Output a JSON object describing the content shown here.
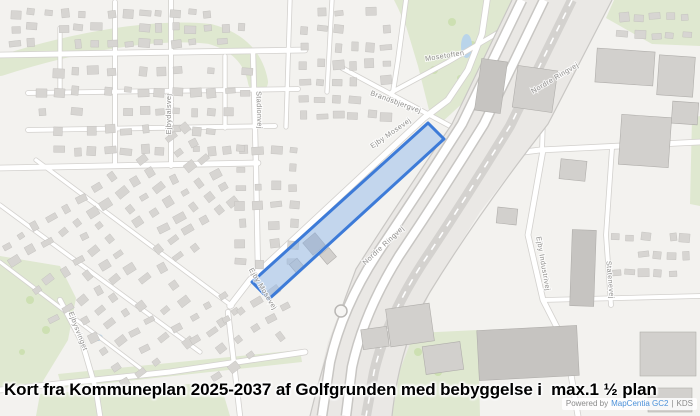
{
  "caption": {
    "text": "Kort fra Kommuneplan 2025-2037 af Golfgrunden med bebyggelse i  max.1 ½ plan"
  },
  "attribution": {
    "powered_by": "Powered by",
    "provider": "MapCentia GC2",
    "separator": "|",
    "suffix": "KDS"
  },
  "map": {
    "background": "#f3f2ef",
    "colors": {
      "green": "#dfe8d0",
      "tree": "#cde0b2",
      "water": "#b9d4ea",
      "building": "#d7d5d2",
      "building_dark": "#c6c4c1",
      "building_light": "#d2d0cd",
      "street_casing": "#d3d1ce",
      "street_fill": "#ffffff",
      "corridor": "#eae8e5",
      "road_casing": "#c8c6c3",
      "rail": "#d4d2cf",
      "label": "#8f8e8c",
      "zone_fill": "#8ab4ea",
      "zone_stroke": "#3d7bd8"
    },
    "greens": [
      "394,0 545,0 536,16 498,62 466,100 440,124 430,114 418,66 406,26 398,8",
      "548,0 610,0 562,96 540,130 524,104 538,58",
      "0,256 60,266 76,298 68,340 40,386 0,390",
      "58,374 300,350 302,362 62,388",
      "40,394 220,382 230,416 36,416",
      "396,334 478,330 480,416 370,416 382,368",
      "614,0 700,0 700,46 652,44 606,18",
      "692,118 700,116 700,206 690,204"
    ],
    "green_band": "M 0,66 C 80,40 160,28 210,34 C 240,42 254,60 258,82",
    "trees": [
      [
        452,
        22,
        4
      ],
      [
        472,
        46,
        5
      ],
      [
        498,
        34,
        4
      ],
      [
        434,
        70,
        4
      ],
      [
        460,
        78,
        3
      ],
      [
        524,
        12,
        4
      ],
      [
        540,
        16,
        3
      ],
      [
        30,
        300,
        4
      ],
      [
        46,
        330,
        4
      ],
      [
        22,
        352,
        3
      ],
      [
        418,
        352,
        4
      ],
      [
        438,
        372,
        4
      ]
    ],
    "ponds": [
      [
        461,
        34,
        11,
        24
      ],
      [
        93,
        334,
        10,
        7
      ]
    ],
    "streets": [
      {
        "pts": [
          [
            0,
            55
          ],
          [
            305,
            50
          ]
        ],
        "w": 5
      },
      {
        "pts": [
          [
            28,
            93
          ],
          [
            298,
            89
          ]
        ],
        "w": 4
      },
      {
        "pts": [
          [
            28,
            130
          ],
          [
            275,
            126
          ]
        ],
        "w": 4
      },
      {
        "pts": [
          [
            0,
            168
          ],
          [
            258,
            163
          ]
        ],
        "w": 5
      },
      {
        "pts": [
          [
            115,
            2
          ],
          [
            115,
            166
          ]
        ],
        "w": 4
      },
      {
        "pts": [
          [
            171,
            0
          ],
          [
            171,
            166
          ]
        ],
        "w": 4
      },
      {
        "pts": [
          [
            225,
            56
          ],
          [
            225,
            128
          ]
        ],
        "w": 3.5
      },
      {
        "pts": [
          [
            253,
            52
          ],
          [
            256,
            168
          ],
          [
            258,
            272
          ]
        ],
        "w": 4.5
      },
      {
        "pts": [
          [
            60,
            28
          ],
          [
            60,
            93
          ]
        ],
        "w": 3.5
      },
      {
        "pts": [
          [
            290,
            0
          ],
          [
            286,
            127
          ]
        ],
        "w": 3.5
      },
      {
        "pts": [
          [
            332,
            0
          ],
          [
            327,
            92
          ]
        ],
        "w": 3.5
      },
      {
        "pts": [
          [
            228,
            312
          ],
          [
            240,
            416
          ]
        ],
        "w": 4.5
      },
      {
        "pts": [
          [
            0,
            390
          ],
          [
            170,
            372
          ],
          [
            305,
            352
          ]
        ],
        "w": 5
      },
      {
        "pts": [
          [
            60,
            300
          ],
          [
            82,
            342
          ],
          [
            96,
            390
          ],
          [
            100,
            416
          ]
        ],
        "w": 4.5
      },
      {
        "pts": [
          [
            230,
            306
          ],
          [
            250,
            280
          ],
          [
            424,
            118
          ],
          [
            448,
            100
          ],
          [
            468,
            70
          ],
          [
            482,
            34
          ],
          [
            487,
            0
          ]
        ],
        "w": 5.5
      },
      {
        "pts": [
          [
            342,
            68
          ],
          [
            450,
            126
          ]
        ],
        "w": 4
      },
      {
        "pts": [
          [
            392,
            92
          ],
          [
            448,
            62
          ],
          [
            530,
            14
          ]
        ],
        "w": 4
      },
      {
        "pts": [
          [
            406,
            0
          ],
          [
            398,
            60
          ],
          [
            393,
            92
          ]
        ],
        "w": 4
      },
      {
        "pts": [
          [
            500,
            155
          ],
          [
            540,
            150
          ],
          [
            700,
            142
          ]
        ],
        "w": 5
      },
      {
        "pts": [
          [
            545,
            58
          ],
          [
            542,
            150
          ]
        ],
        "w": 4
      },
      {
        "pts": [
          [
            543,
            150
          ],
          [
            528,
            235
          ],
          [
            543,
            300
          ],
          [
            566,
            345
          ],
          [
            578,
            416
          ]
        ],
        "w": 5
      },
      {
        "pts": [
          [
            612,
            148
          ],
          [
            606,
            235
          ],
          [
            611,
            305
          ]
        ],
        "w": 4
      },
      {
        "pts": [
          [
            543,
            300
          ],
          [
            700,
            296
          ]
        ],
        "w": 4
      },
      {
        "pts": [
          [
            0,
            205
          ],
          [
            200,
            352
          ]
        ],
        "w": 3.5
      },
      {
        "pts": [
          [
            36,
            160
          ],
          [
            232,
            306
          ]
        ],
        "w": 3.5
      },
      {
        "pts": [
          [
            0,
            262
          ],
          [
            140,
            368
          ]
        ],
        "w": 3
      }
    ],
    "corridor": {
      "outline": "512,0 612,0 548,124 480,212 430,292 400,370 392,416 310,416 328,342 356,269 392,212 452,124",
      "roads": [
        "M522,0 L462,124 Q420,190 377,254 Q342,308 330,362 L322,416",
        "M544,0 L484,124 Q442,192 399,256 Q364,312 352,367 L346,416"
      ],
      "rail": "M572,0 L510,126 Q466,198 422,264 Q386,320 374,372 L366,416",
      "edge_ne": "M612,0 L548,124 Q478,214 430,292 Q400,342 392,416",
      "edge_sw": "M512,0 L452,124 Q392,212 356,269 Q328,342 310,416",
      "roundabout": {
        "cx": 341,
        "cy": 311,
        "r": 6
      }
    },
    "zone": {
      "points": "252,282 428,123 444,139 269,299"
    },
    "buildings_large": [
      [
        478,
        60,
        26,
        52,
        8,
        "b"
      ],
      [
        515,
        68,
        40,
        42,
        8,
        "a"
      ],
      [
        596,
        50,
        58,
        34,
        4,
        "a"
      ],
      [
        658,
        56,
        36,
        40,
        4,
        "a"
      ],
      [
        620,
        116,
        50,
        50,
        4,
        "a"
      ],
      [
        672,
        102,
        26,
        22,
        4,
        "a"
      ],
      [
        560,
        160,
        26,
        20,
        6,
        "a"
      ],
      [
        497,
        208,
        20,
        16,
        6,
        "a"
      ],
      [
        571,
        230,
        24,
        76,
        2,
        "b"
      ],
      [
        478,
        328,
        100,
        50,
        -3,
        "b"
      ],
      [
        388,
        306,
        44,
        38,
        -8,
        "a"
      ],
      [
        424,
        344,
        38,
        28,
        -8,
        "a"
      ],
      [
        362,
        328,
        26,
        20,
        -8,
        "a"
      ],
      [
        640,
        332,
        56,
        44,
        0,
        "a"
      ],
      [
        648,
        388,
        44,
        24,
        0,
        "a"
      ],
      [
        306,
        236,
        16,
        16,
        -40,
        "b"
      ],
      [
        322,
        250,
        12,
        12,
        -40,
        "a"
      ],
      [
        292,
        260,
        10,
        12,
        -40,
        "a"
      ]
    ],
    "building_regions": [
      [
        8,
        6,
        240,
        44,
        0,
        15,
        3
      ],
      [
        296,
        4,
        100,
        120,
        0,
        6,
        7
      ],
      [
        34,
        62,
        220,
        98,
        0,
        13,
        5
      ],
      [
        4,
        172,
        232,
        104,
        -33,
        13,
        6
      ],
      [
        84,
        268,
        150,
        96,
        -33,
        8,
        5
      ],
      [
        232,
        140,
        70,
        132,
        0,
        4,
        7
      ],
      [
        610,
        228,
        82,
        54,
        0,
        6,
        3
      ],
      [
        190,
        302,
        112,
        62,
        -33,
        6,
        3
      ],
      [
        616,
        8,
        78,
        36,
        0,
        5,
        2
      ]
    ],
    "labels": [
      {
        "text": "Nordre Ringvej",
        "x": 556,
        "y": 80,
        "r": -31
      },
      {
        "text": "Nordre Ringvej",
        "x": 385,
        "y": 247,
        "r": -43
      },
      {
        "text": "Ejby Mosevej",
        "x": 392,
        "y": 135,
        "r": -35
      },
      {
        "text": "Brandsbjergvej",
        "x": 395,
        "y": 104,
        "r": 20
      },
      {
        "text": "Mosetoften",
        "x": 445,
        "y": 58,
        "r": -9
      },
      {
        "text": "Ejby Industrivej",
        "x": 541,
        "y": 264,
        "r": 80
      },
      {
        "text": "Ejbydalsvej",
        "x": 171,
        "y": 114,
        "r": -90
      },
      {
        "text": "Stadionvej",
        "x": 257,
        "y": 110,
        "r": 88
      },
      {
        "text": "Ejbysvinget",
        "x": 76,
        "y": 332,
        "r": 69
      },
      {
        "text": "Ejby Mosevej",
        "x": 261,
        "y": 290,
        "r": 59
      },
      {
        "text": "Statenevej",
        "x": 608,
        "y": 280,
        "r": 85
      }
    ]
  }
}
